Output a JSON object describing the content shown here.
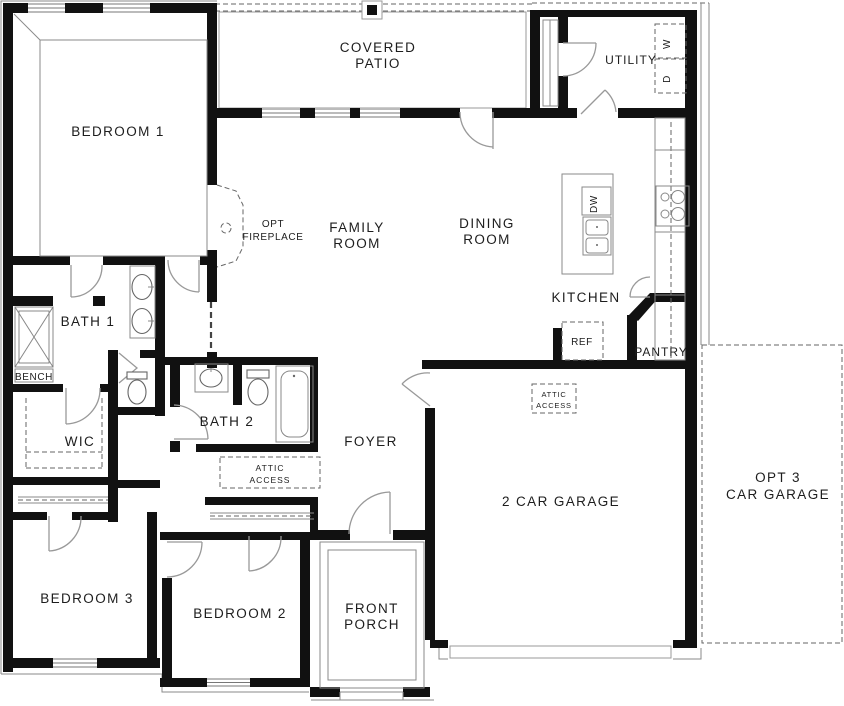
{
  "plan_title": "Single-story floor plan",
  "colors": {
    "wall": "#111111",
    "thin_line": "#8a8a8a",
    "dashed_line": "#666666",
    "text": "#1d1d1d",
    "background": "#ffffff"
  },
  "labels": {
    "bedroom1": "BEDROOM 1",
    "bedroom2": "BEDROOM 2",
    "bedroom3": "BEDROOM 3",
    "covered_patio_line1": "COVERED",
    "covered_patio_line2": "PATIO",
    "utility": "UTILITY",
    "washer": "W",
    "dryer": "D",
    "family_room_line1": "FAMILY",
    "family_room_line2": "ROOM",
    "dining_room_line1": "DINING",
    "dining_room_line2": "ROOM",
    "opt_fireplace_line1": "OPT",
    "opt_fireplace_line2": "FIREPLACE",
    "kitchen": "KITCHEN",
    "dishwasher": "DW",
    "refrigerator": "REF",
    "pantry": "PANTRY",
    "bath1": "BATH 1",
    "bench": "BENCH",
    "wic": "WIC",
    "bath2": "BATH 2",
    "foyer": "FOYER",
    "attic_access_line1": "ATTIC",
    "attic_access_line2": "ACCESS",
    "garage": "2 CAR GARAGE",
    "opt_garage_line1": "OPT 3",
    "opt_garage_line2": "CAR GARAGE",
    "front_porch_line1": "FRONT",
    "front_porch_line2": "PORCH"
  }
}
